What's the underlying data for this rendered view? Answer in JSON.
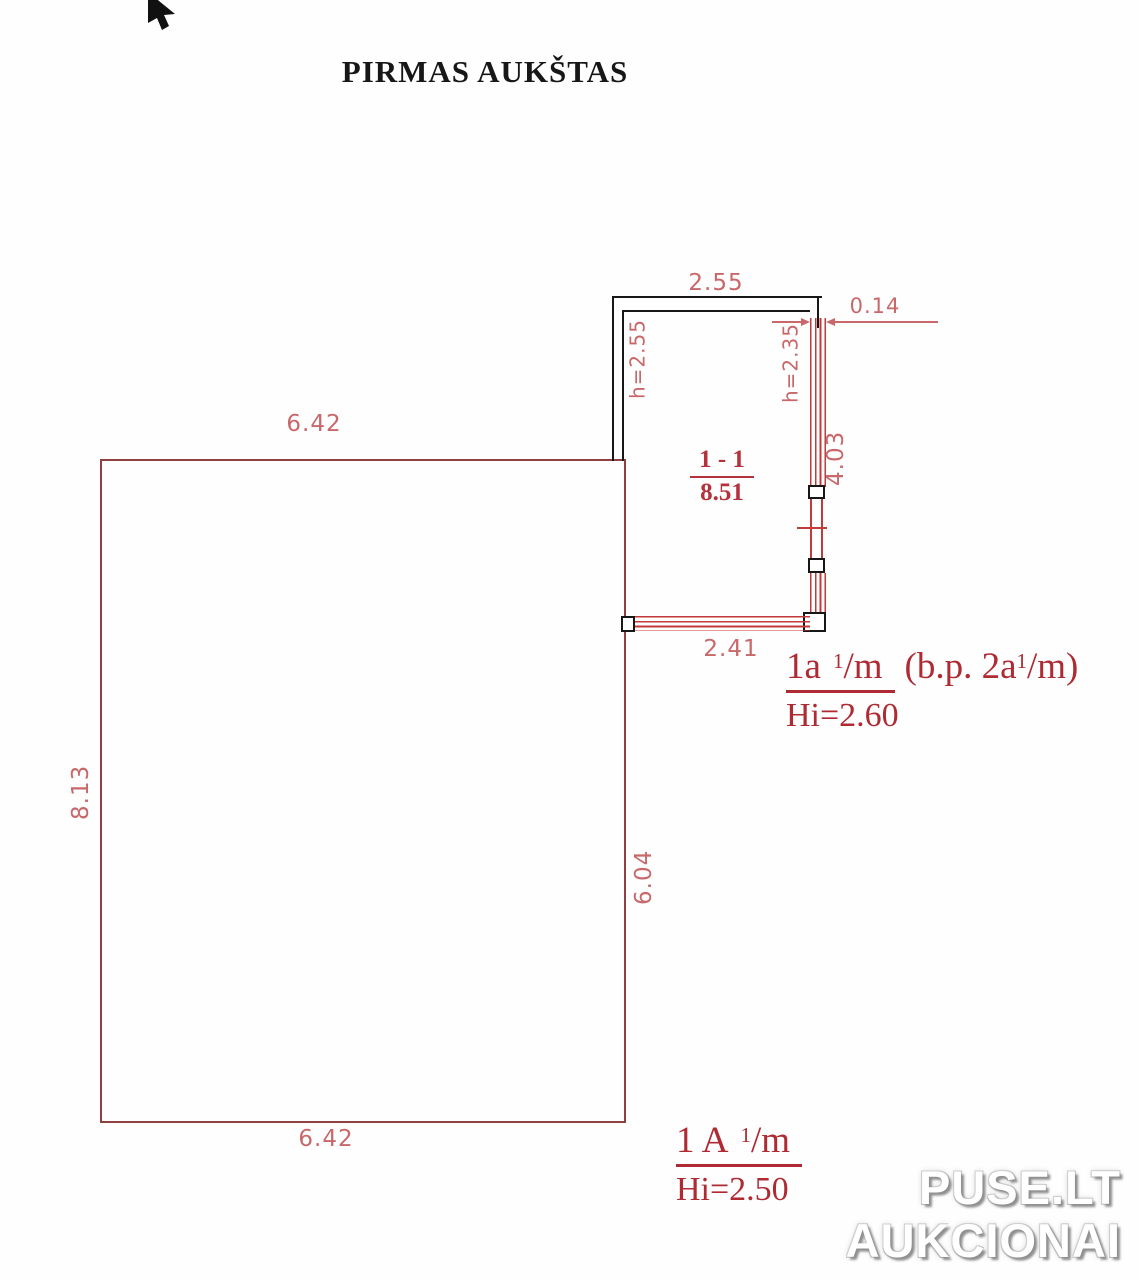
{
  "title": "PIRMAS AUKŠTAS",
  "cursor_icon": "nw-arrow-cursor",
  "plan": {
    "room_label": {
      "number": "1 - 1",
      "area": "8.51"
    },
    "dimensions": {
      "annex_top_width": "2.55",
      "wall_thickness": "0.14",
      "annex_right_height": "4.03",
      "annex_bottom_width": "2.41",
      "annex_left_wall_height": "h=2.55",
      "annex_right_wall_height": "h=2.35",
      "main_top_width": "6.42",
      "main_left_height": "8.13",
      "main_inner_right_height": "6.04",
      "main_bottom_width": "6.42"
    },
    "annex_note": {
      "code_main": "1a",
      "code_sup": "1",
      "code_tail": "/m",
      "extra_open": "(b.p. 2a",
      "extra_sup": "1",
      "extra_tail": "/m)",
      "height": "Hi=2.60"
    },
    "main_note": {
      "code_main": "1 A",
      "code_sup": "1",
      "code_tail": "/m",
      "height": "Hi=2.50"
    }
  },
  "watermark": {
    "line1": "PUSE.LT",
    "line2": "AUKCIONAI"
  },
  "colors": {
    "drawing_red": "#c23b3b",
    "dimension_red": "#c8686a",
    "note_red": "#ae2b34",
    "outline_red": "#8f4040",
    "ink_black": "#171717",
    "watermark_fill": "#ffffff",
    "watermark_shadow": "#909090"
  }
}
